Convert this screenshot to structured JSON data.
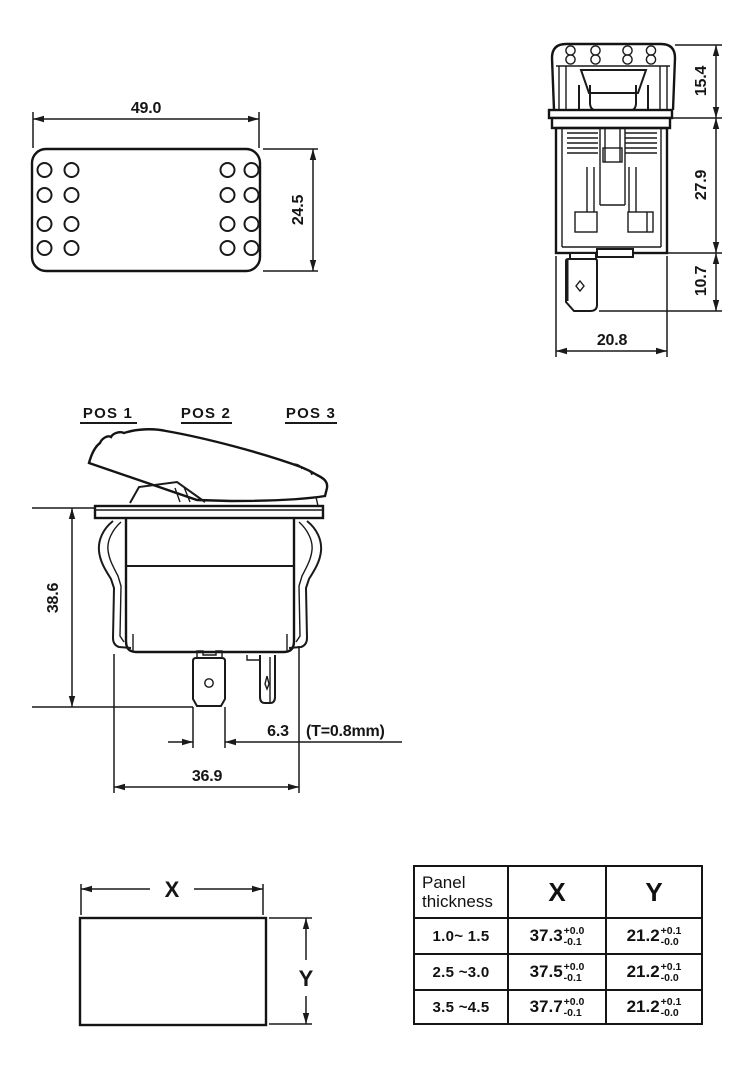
{
  "drawing": {
    "top_view": {
      "width_dim": "49.0",
      "height_dim": "24.5"
    },
    "side_view": {
      "height_top": "15.4",
      "height_body": "27.9",
      "height_terminal": "10.7",
      "width_dim": "20.8"
    },
    "front_view": {
      "pos_labels": [
        "POS 1",
        "POS 2",
        "POS 3"
      ],
      "height_dim": "38.6",
      "terminal_width": "6.3",
      "terminal_note": "(T=0.8mm)",
      "width_dim": "36.9"
    },
    "cutout": {
      "x_label": "X",
      "y_label": "Y"
    }
  },
  "table": {
    "headers": {
      "col1": "Panel thickness",
      "col2": "X",
      "col3": "Y"
    },
    "rows": [
      {
        "thickness": "1.0~ 1.5",
        "x": "37.3",
        "x_plus": "+0.0",
        "x_minus": "-0.1",
        "y": "21.2",
        "y_plus": "+0.1",
        "y_minus": "-0.0"
      },
      {
        "thickness": "2.5 ~3.0",
        "x": "37.5",
        "x_plus": "+0.0",
        "x_minus": "-0.1",
        "y": "21.2",
        "y_plus": "+0.1",
        "y_minus": "-0.0"
      },
      {
        "thickness": "3.5 ~4.5",
        "x": "37.7",
        "x_plus": "+0.0",
        "x_minus": "-0.1",
        "y": "21.2",
        "y_plus": "+0.1",
        "y_minus": "-0.0"
      }
    ]
  }
}
